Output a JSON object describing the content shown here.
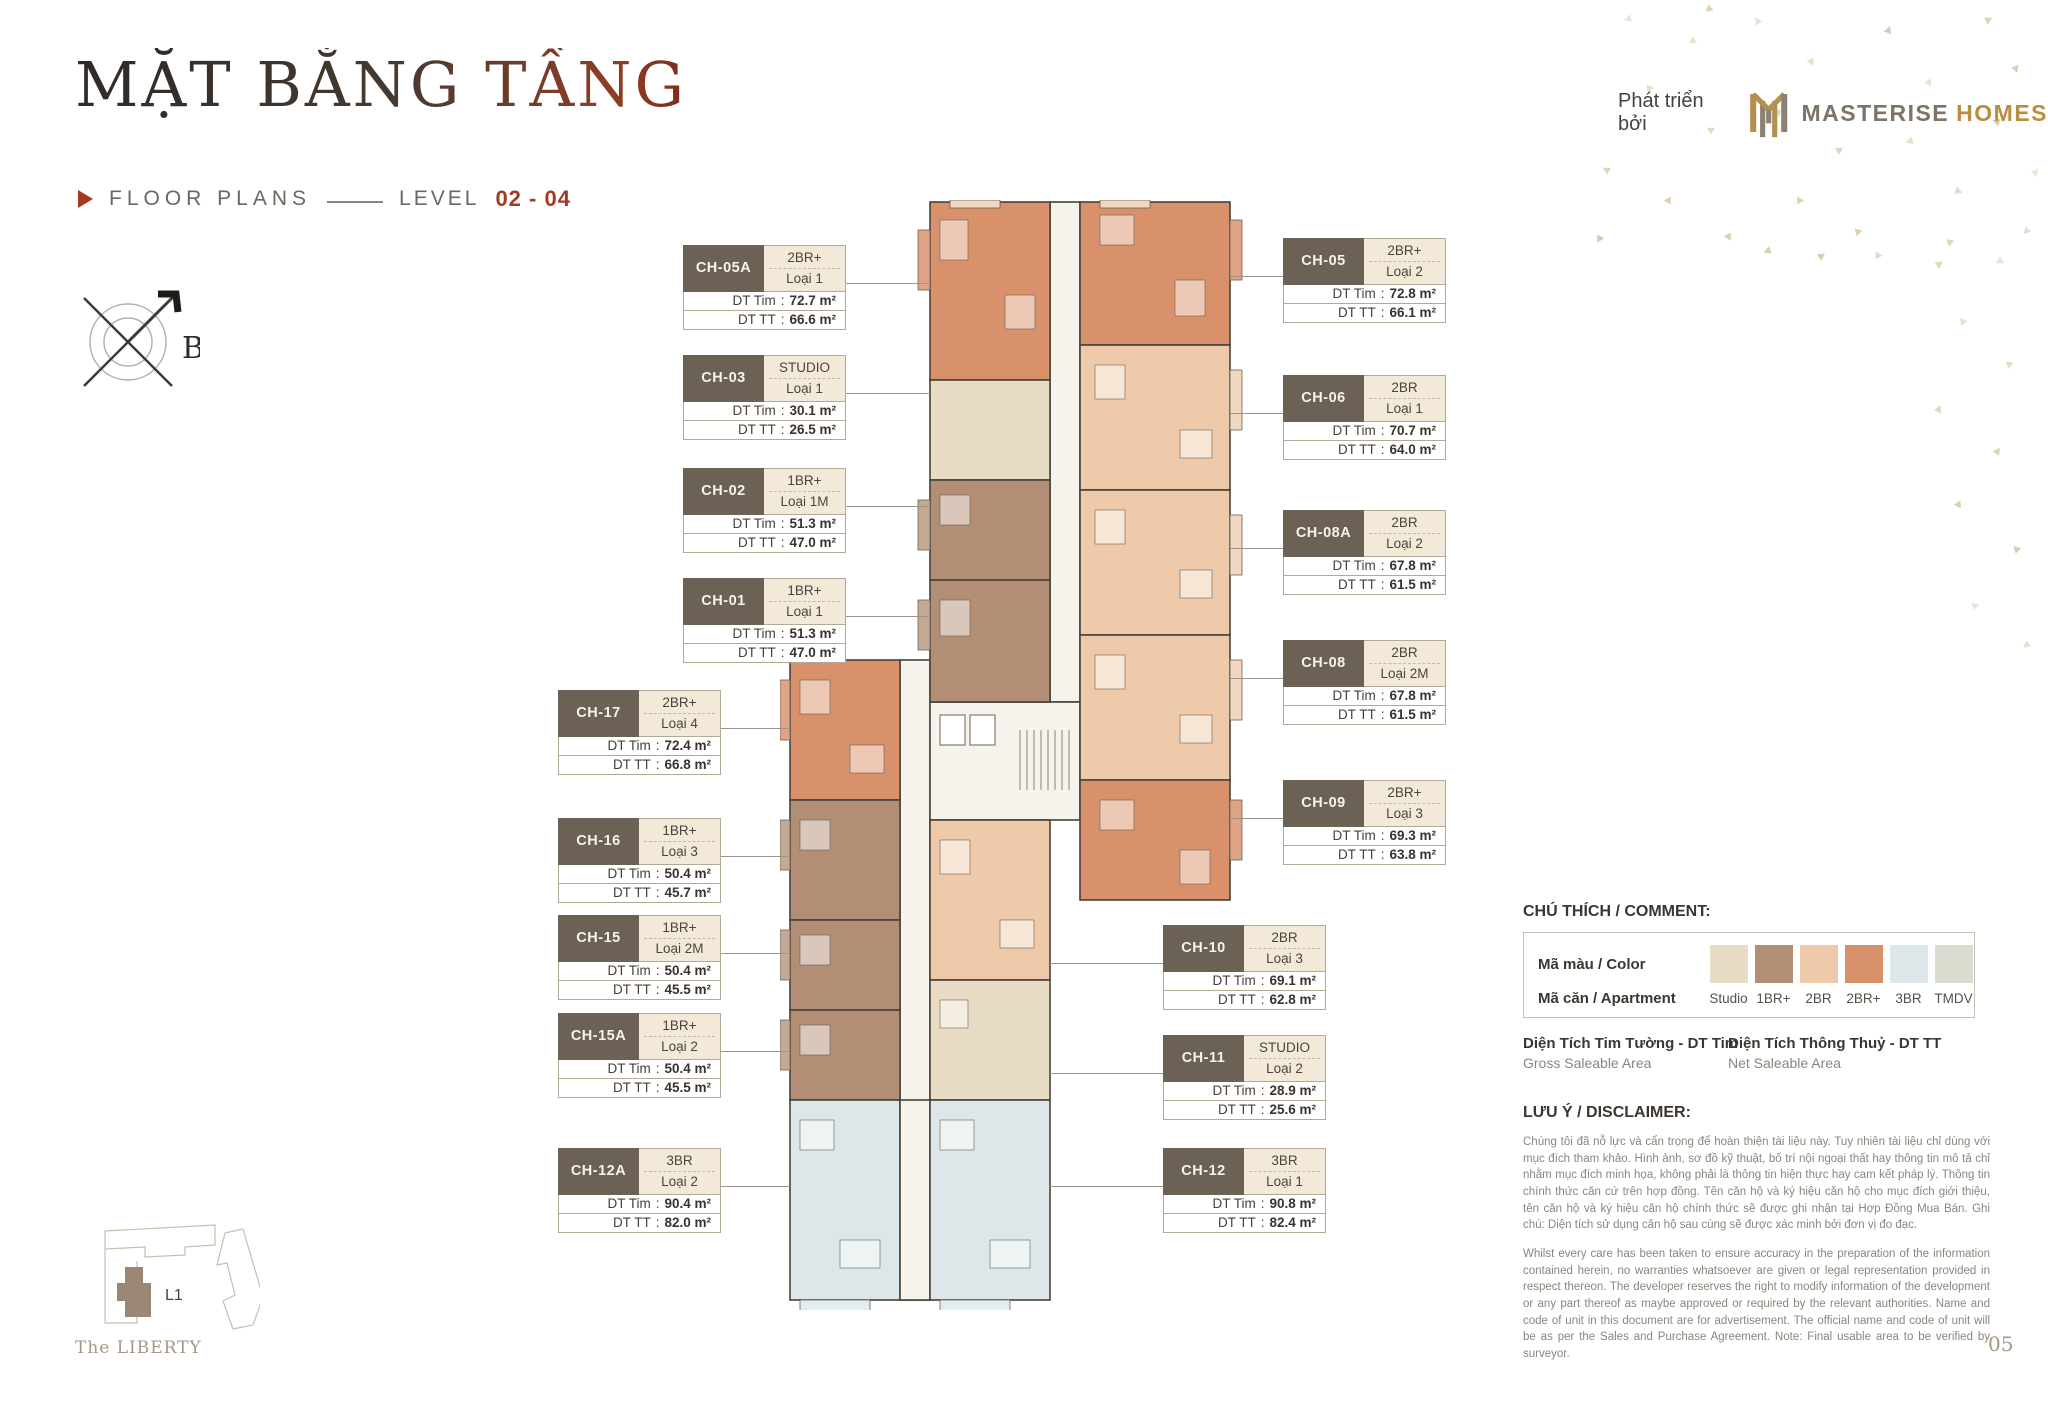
{
  "header": {
    "title": "MẶT BẰNG TẦNG",
    "subtitle": {
      "label": "FLOOR PLANS",
      "level": "LEVEL",
      "range": "02 - 04"
    },
    "developer": {
      "prefix": "Phát triển bởi",
      "name_primary": "MASTERISE",
      "name_secondary": "HOMES"
    }
  },
  "compass": {
    "label": "B"
  },
  "labels": {
    "dt_tim": "DT Tim",
    "dt_tt": "DT TT"
  },
  "units": {
    "left": [
      {
        "id": "CH-05A",
        "type": "2BR+",
        "variant": "Loại 1",
        "dt_tim": "72.7 m²",
        "dt_tt": "66.6 m²"
      },
      {
        "id": "CH-03",
        "type": "STUDIO",
        "variant": "Loại 1",
        "dt_tim": "30.1 m²",
        "dt_tt": "26.5 m²"
      },
      {
        "id": "CH-02",
        "type": "1BR+",
        "variant": "Loại 1M",
        "dt_tim": "51.3 m²",
        "dt_tt": "47.0 m²"
      },
      {
        "id": "CH-01",
        "type": "1BR+",
        "variant": "Loại 1",
        "dt_tim": "51.3 m²",
        "dt_tt": "47.0 m²"
      },
      {
        "id": "CH-17",
        "type": "2BR+",
        "variant": "Loại 4",
        "dt_tim": "72.4 m²",
        "dt_tt": "66.8 m²"
      },
      {
        "id": "CH-16",
        "type": "1BR+",
        "variant": "Loại 3",
        "dt_tim": "50.4 m²",
        "dt_tt": "45.7 m²"
      },
      {
        "id": "CH-15",
        "type": "1BR+",
        "variant": "Loại 2M",
        "dt_tim": "50.4 m²",
        "dt_tt": "45.5 m²"
      },
      {
        "id": "CH-15A",
        "type": "1BR+",
        "variant": "Loại 2",
        "dt_tim": "50.4 m²",
        "dt_tt": "45.5 m²"
      },
      {
        "id": "CH-12A",
        "type": "3BR",
        "variant": "Loại 2",
        "dt_tim": "90.4 m²",
        "dt_tt": "82.0 m²"
      }
    ],
    "right": [
      {
        "id": "CH-05",
        "type": "2BR+",
        "variant": "Loại 2",
        "dt_tim": "72.8 m²",
        "dt_tt": "66.1 m²"
      },
      {
        "id": "CH-06",
        "type": "2BR",
        "variant": "Loại 1",
        "dt_tim": "70.7 m²",
        "dt_tt": "64.0 m²"
      },
      {
        "id": "CH-08A",
        "type": "2BR",
        "variant": "Loại 2",
        "dt_tim": "67.8 m²",
        "dt_tt": "61.5 m²"
      },
      {
        "id": "CH-08",
        "type": "2BR",
        "variant": "Loại 2M",
        "dt_tim": "67.8 m²",
        "dt_tt": "61.5 m²"
      },
      {
        "id": "CH-09",
        "type": "2BR+",
        "variant": "Loại 3",
        "dt_tim": "69.3 m²",
        "dt_tt": "63.8 m²"
      },
      {
        "id": "CH-10",
        "type": "2BR",
        "variant": "Loại 3",
        "dt_tim": "69.1 m²",
        "dt_tt": "62.8 m²"
      },
      {
        "id": "CH-11",
        "type": "STUDIO",
        "variant": "Loại 2",
        "dt_tim": "28.9 m²",
        "dt_tt": "25.6 m²"
      },
      {
        "id": "CH-12",
        "type": "3BR",
        "variant": "Loại 1",
        "dt_tim": "90.8 m²",
        "dt_tt": "82.4 m²"
      }
    ]
  },
  "legend": {
    "title": "CHÚ THÍCH / COMMENT:",
    "color_row_label": "Mã màu / Color",
    "apartment_row_label": "Mã căn / Apartment",
    "items": [
      {
        "label": "Studio",
        "color": "#e8dcc5"
      },
      {
        "label": "1BR+",
        "color": "#b18e74"
      },
      {
        "label": "2BR",
        "color": "#eecaaa"
      },
      {
        "label": "2BR+",
        "color": "#d8916a"
      },
      {
        "label": "3BR",
        "color": "#dde7e9"
      },
      {
        "label": "TMDV",
        "color": "#dadcd0"
      }
    ],
    "gross": {
      "vi": "Diện Tích Tim Tường - DT Tim",
      "en": "Gross Saleable Area"
    },
    "net": {
      "vi": "Diện Tích Thông Thuỷ - DT TT",
      "en": "Net Saleable Area"
    }
  },
  "disclaimer": {
    "title": "LƯU Ý / DISCLAIMER:",
    "vi": "Chúng tôi đã nỗ lực và cẩn trọng để hoàn thiện tài liệu này. Tuy nhiên tài liệu chỉ dùng với mục đích tham khảo. Hình ảnh, sơ đồ kỹ thuật, bố trí nội ngoại thất hay thông tin mô tả chỉ nhằm mục đích minh họa, không phải là thông tin hiện thực hay cam kết pháp lý. Thông tin chính thức căn cứ trên hợp đồng. Tên căn hộ và ký hiệu căn hộ cho mục đích giới thiệu, tên căn hộ và ký hiệu căn hộ chính thức sẽ được ghi nhận tại Hợp Đồng Mua Bán. Ghi chú: Diện tích sử dụng căn hộ sau cùng sẽ được xác minh bởi đơn vị đo đạc.",
    "en": "Whilst every care has been taken to ensure accuracy in the preparation of the information contained herein, no warranties whatsoever are given or legal representation provided in respect thereon. The developer reserves the right to modify information of the development or any part thereof as maybe approved or required by the relevant authorities. Name and code of unit in this document are for advertisement. The official name and code of unit will be as per the Sales and Purchase Agreement. Note: Final usable area to be verified by surveyor."
  },
  "siteplan": {
    "building_label": "L1"
  },
  "footer": {
    "project": "The LIBERTY",
    "page": "05"
  },
  "accent_color": "#a43a24"
}
